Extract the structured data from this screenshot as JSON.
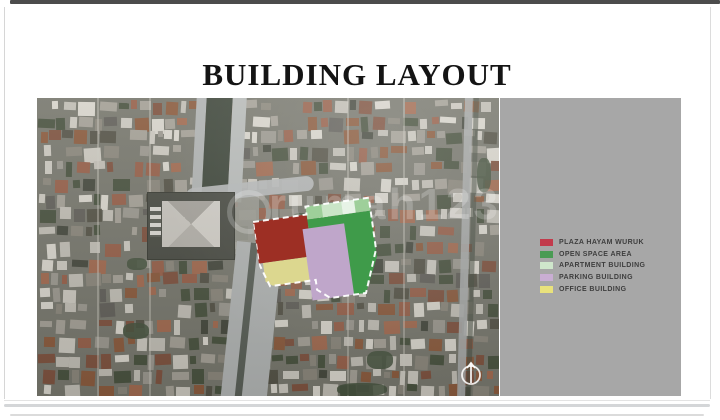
{
  "title": "BUILDING LAYOUT",
  "map": {
    "watermark": "rumah123",
    "north_icon": "compass-north"
  },
  "legend": {
    "items": [
      {
        "id": "plaza",
        "label": "PLAZA HAYAM WURUK",
        "swatch": "#c23b4c",
        "map_color": "#9d2f24"
      },
      {
        "id": "open-space",
        "label": "OPEN SPACE AREA",
        "swatch": "#4a9b54",
        "map_color": "#3f9b4a"
      },
      {
        "id": "apartment",
        "label": "APARTMENT BUILDING",
        "swatch": "#cfe6cb",
        "map_color": "#9ecf9a"
      },
      {
        "id": "parking",
        "label": "PARKING BUILDING",
        "swatch": "#c9aed3",
        "map_color": "#bfa6ca"
      },
      {
        "id": "office",
        "label": "OFFICE BUILDING",
        "swatch": "#e9e27c",
        "map_color": "#dcd78f"
      }
    ]
  },
  "colors": {
    "panel_bg": "#a7a7a7",
    "outline": "#ffffff"
  }
}
